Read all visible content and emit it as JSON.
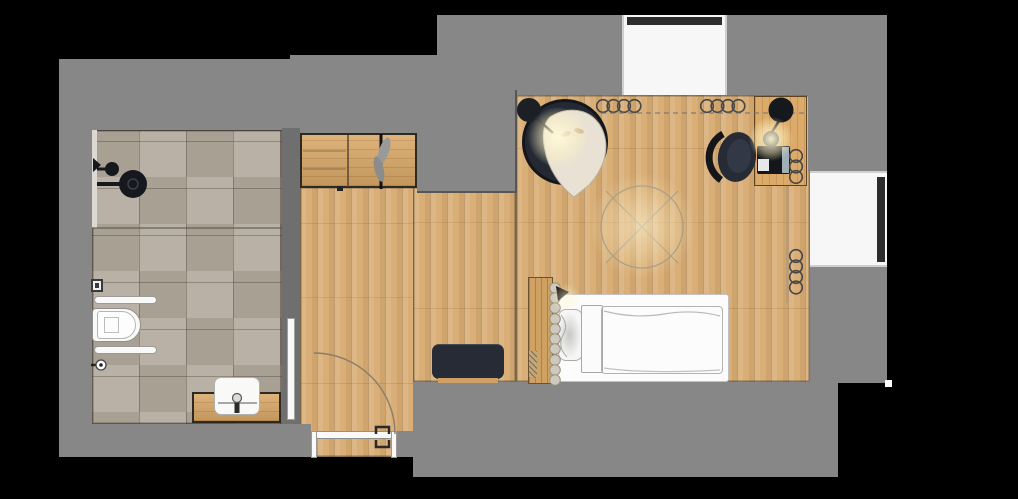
{
  "title": "attic-studio-floor-plan",
  "colors": {
    "wall": "#878787",
    "wallDark": "#6f6f6f",
    "wood": "#d9ae77",
    "woodDeep": "#cf9f63",
    "tile": "#b3aa9d",
    "dark": "#262b35",
    "white": "#f7f7f7",
    "cushion": "#e9e1d3",
    "glow": "#fff3c4"
  },
  "rooms": [
    {
      "name": "bathroom",
      "floor": "stone-tile",
      "fixtures": [
        "shower-head",
        "hand-shower",
        "glass-screen",
        "flush-plate",
        "towel-rail",
        "wall-hung-toilet",
        "towel-rail",
        "floor-valve",
        "vanity-counter",
        "washbasin",
        "door-leaf"
      ]
    },
    {
      "name": "hallway",
      "floor": "oak-plank",
      "fixtures": [
        "wardrobe",
        "open-wardrobe-door",
        "hanging-garment",
        "bench-ottoman",
        "entrance-door",
        "door-swing-arc"
      ]
    },
    {
      "name": "bedroom",
      "floor": "oak-plank",
      "fixtures": [
        "armchair",
        "floor-lamp",
        "radiator-coil",
        "radiator-coil",
        "ceiling-light-circle",
        "desk",
        "desk-lamp",
        "laptop",
        "office-chair",
        "radiator-coil",
        "radiator-coil",
        "bed-headboard",
        "mattress",
        "pillow",
        "duvet",
        "reading-light",
        "window",
        "window"
      ]
    }
  ],
  "rects": {
    "walls": {
      "top_left": [
        59,
        59,
        231,
        71
      ],
      "top_mid": [
        290,
        55,
        147,
        78
      ],
      "left_col": [
        59,
        59,
        33,
        398
      ],
      "top_r1": [
        437,
        15,
        185,
        80
      ],
      "top_r2": [
        727,
        15,
        160,
        80
      ],
      "nook_block": [
        417,
        90,
        100,
        103
      ],
      "right_up": [
        808,
        95,
        79,
        77
      ],
      "right_low": [
        810,
        267,
        77,
        116
      ],
      "bottom_mass": [
        413,
        382,
        425,
        95
      ],
      "bath_bottom": [
        59,
        424,
        252,
        33
      ],
      "entry_right": [
        397,
        431,
        16,
        26
      ],
      "bath_right": [
        282,
        128,
        18,
        296
      ],
      "notch_white": [
        885,
        380,
        7,
        7
      ]
    },
    "floors": {
      "bath": [
        92,
        130,
        190,
        294
      ],
      "hall": [
        300,
        187,
        117,
        270
      ],
      "nook": [
        413,
        187,
        103,
        195
      ],
      "bed": [
        516,
        95,
        294,
        287
      ],
      "bath_top_line": [
        88,
        128,
        194,
        3
      ]
    },
    "windows": {
      "top_recess": [
        622,
        15,
        105,
        80
      ],
      "top_frame": [
        627,
        17,
        95,
        8
      ],
      "right_recess": [
        810,
        171,
        77,
        96
      ],
      "right_frame": [
        877,
        177,
        8,
        85
      ]
    },
    "bathroom": {
      "glass_strip": [
        92,
        130,
        5,
        98
      ],
      "glass_line": [
        92,
        227,
        190,
        2
      ],
      "flush_plate": [
        91,
        279,
        12,
        13
      ],
      "towel_bar1": [
        94,
        296,
        63,
        8
      ],
      "towel_bar2": [
        94,
        346,
        63,
        8
      ],
      "toilet_outer": [
        92,
        308,
        49,
        34
      ],
      "toilet_inner": [
        97,
        311,
        39,
        28
      ],
      "toilet_tank": [
        104,
        317,
        15,
        16
      ],
      "vanity": [
        192,
        392,
        89,
        31
      ],
      "basin": [
        214,
        377,
        46,
        38
      ],
      "door_leaf": [
        287,
        318,
        8,
        102
      ]
    },
    "hallway": {
      "cabinet": [
        300,
        133,
        117,
        55
      ],
      "bench": [
        432,
        344,
        72,
        35
      ],
      "bench_base": [
        438,
        378,
        60,
        5
      ],
      "entry_bar": [
        311,
        431,
        86,
        8
      ],
      "entry_jamb_l": [
        311,
        431,
        6,
        27
      ],
      "entry_jamb_r": [
        391,
        431,
        6,
        27
      ]
    },
    "bedroom": {
      "desk": [
        754,
        96,
        53,
        90
      ],
      "laptop": [
        757,
        146,
        33,
        28
      ],
      "laptop_screen": [
        782,
        147,
        7,
        26
      ],
      "laptop_kbd": [
        758,
        159,
        11,
        12
      ],
      "headboard": [
        528,
        277,
        25,
        107
      ],
      "hatch": [
        529,
        351,
        8,
        27
      ],
      "mattress": [
        556,
        294,
        173,
        88
      ],
      "pillow": [
        558,
        309,
        25,
        52
      ],
      "throw": [
        581,
        305,
        22,
        68
      ],
      "duvet": [
        601,
        306,
        122,
        68
      ]
    },
    "glows": {
      "chair": [
        528,
        107,
        60,
        60
      ],
      "desk": [
        749,
        117,
        44,
        44
      ],
      "room": [
        587,
        171,
        110,
        110
      ],
      "bed": [
        550,
        284,
        32,
        28
      ]
    }
  }
}
